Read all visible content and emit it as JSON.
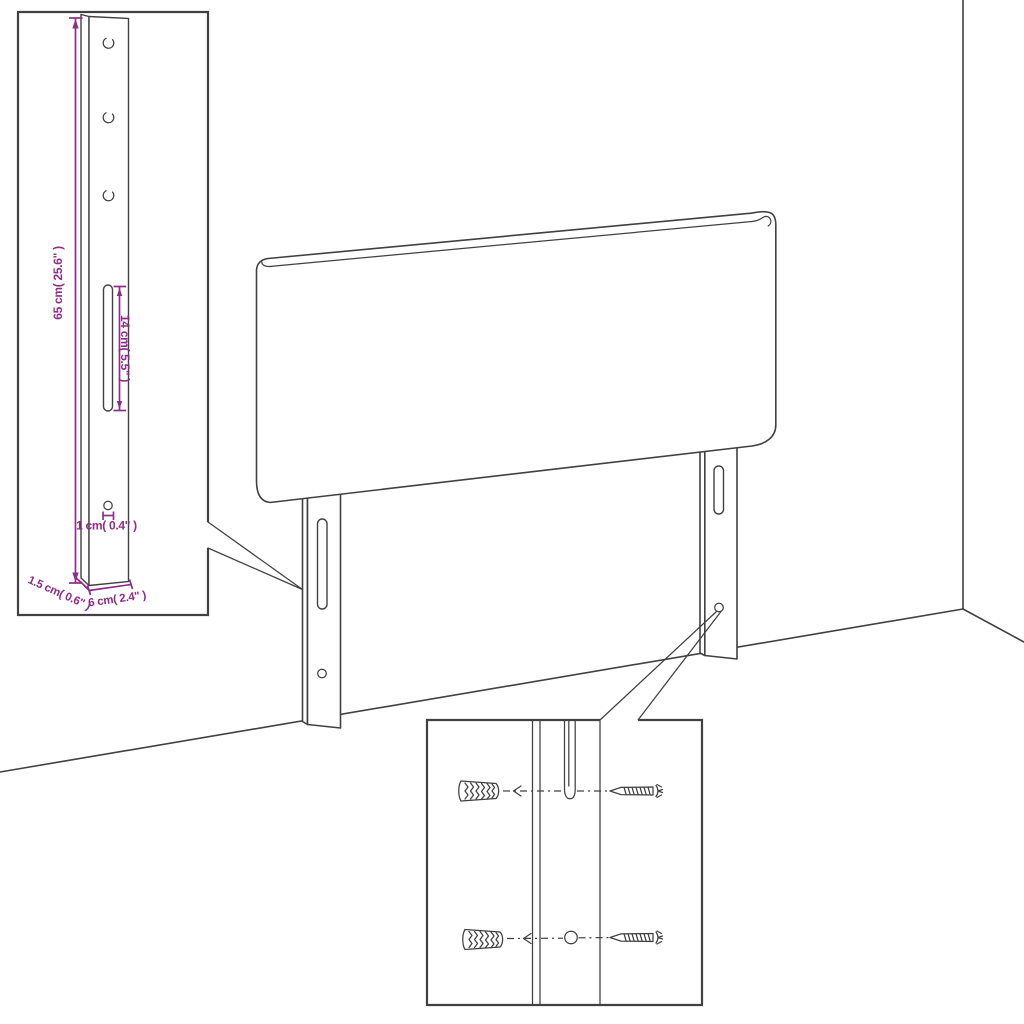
{
  "colors": {
    "background": "#FFFFFF",
    "line": "#414141",
    "dimension": "#8E2C88"
  },
  "leg_detail_inset": {
    "height_label": "65 cm( 25.6\" )",
    "slot_label": "14 cm( 5.5\" )",
    "hole_label": "1 cm( 0.4\" )",
    "depth_label": "1.5 cm( 0.6\" )",
    "width_label": "6 cm( 2.4\" )"
  },
  "mounting_detail_inset": {
    "icons": [
      "wall-plug-icon",
      "screw-icon",
      "wall-plug-icon",
      "screw-icon"
    ]
  }
}
